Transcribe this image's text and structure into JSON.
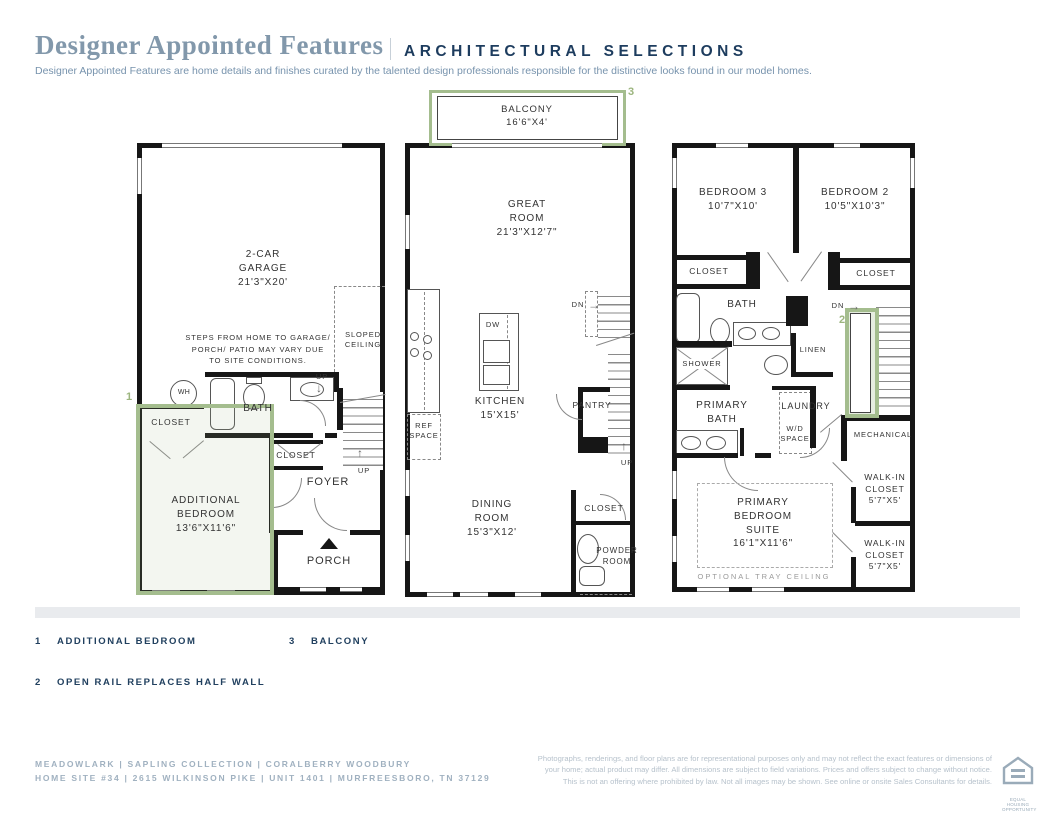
{
  "header": {
    "title": "Designer Appointed Features",
    "section": "ARCHITECTURAL SELECTIONS",
    "tagline": "Designer Appointed Features are home details and finishes curated by the talented design professionals responsible for the distinctive looks found in our model homes."
  },
  "plan1": {
    "garage": "2-CAR\nGARAGE\n21'3\"X20'",
    "steps_note": "STEPS FROM HOME TO GARAGE/\nPORCH/ PATIO MAY VARY DUE\nTO SITE CONDITIONS.",
    "sloped_ceiling": "SLOPED\nCEILING",
    "water_heater": "WH",
    "bath": "BATH",
    "up_entry": "UP",
    "closet_bedroom": "CLOSET",
    "closet_foyer": "CLOSET",
    "foyer": "FOYER",
    "up_stairs": "UP",
    "additional_bedroom": "ADDITIONAL\nBEDROOM\n13'6\"X11'6\"",
    "porch": "PORCH",
    "marker": "1"
  },
  "plan2": {
    "balcony": "BALCONY\n16'6\"X4'",
    "marker_balcony": "3",
    "great_room": "GREAT\nROOM\n21'3\"X12'7\"",
    "dishwasher": "DW",
    "kitchen": "KITCHEN\n15'X15'",
    "ref_space": "REF\nSPACE",
    "down": "DN",
    "pantry": "PANTRY",
    "up": "UP",
    "dining_room": "DINING\nROOM\n15'3\"X12'",
    "closet": "CLOSET",
    "powder_room": "POWDER\nROOM"
  },
  "plan3": {
    "bedroom3": "BEDROOM 3\n10'7\"X10'",
    "bedroom2": "BEDROOM 2\n10'5\"X10'3\"",
    "closet_bed3": "CLOSET",
    "closet_bed2": "CLOSET",
    "bath": "BATH",
    "down": "DN",
    "marker_rail": "2",
    "shower": "SHOWER",
    "linen": "LINEN",
    "primary_bath": "PRIMARY\nBATH",
    "laundry": "LAUNDRY",
    "wd_space": "W/D\nSPACE",
    "mechanical": "MECHANICAL",
    "walkin_closet1": "WALK-IN\nCLOSET\n5'7\"X5'",
    "walkin_closet2": "WALK-IN\nCLOSET\n5'7\"X5'",
    "primary_suite": "PRIMARY\nBEDROOM\nSUITE\n16'1\"X11'6\"",
    "tray_ceiling": "OPTIONAL TRAY CEILING"
  },
  "icons": {
    "up_arrow": "↑",
    "down_arrow": "↓",
    "right_arrow": "→"
  },
  "legend": {
    "items": [
      {
        "num": "1",
        "label": "ADDITIONAL BEDROOM"
      },
      {
        "num": "2",
        "label": "OPEN RAIL REPLACES HALF WALL"
      },
      {
        "num": "3",
        "label": "BALCONY"
      }
    ]
  },
  "footer": {
    "community_line": "MEADOWLARK | SAPLING COLLECTION | CORALBERRY WOODBURY",
    "address_line": "HOME SITE #34 | 2615 WILKINSON PIKE | UNIT 1401 | MURFREESBORO, TN 37129",
    "disclaimer": "Photographs, renderings, and floor plans are for representational purposes only and may not reflect the exact features or dimensions of your home; actual product may differ. All dimensions are subject to field variations. Prices and offers subject to change without notice. This is not an offering where prohibited by law. Not all images may be shown. See online or onsite Sales Consultants for details.",
    "eho_label": "EQUAL HOUSING OPPORTUNITY"
  },
  "colors": {
    "accent_green": "#a4bd8e",
    "navy": "#1d3c5e",
    "title_blue": "#8298ab"
  }
}
